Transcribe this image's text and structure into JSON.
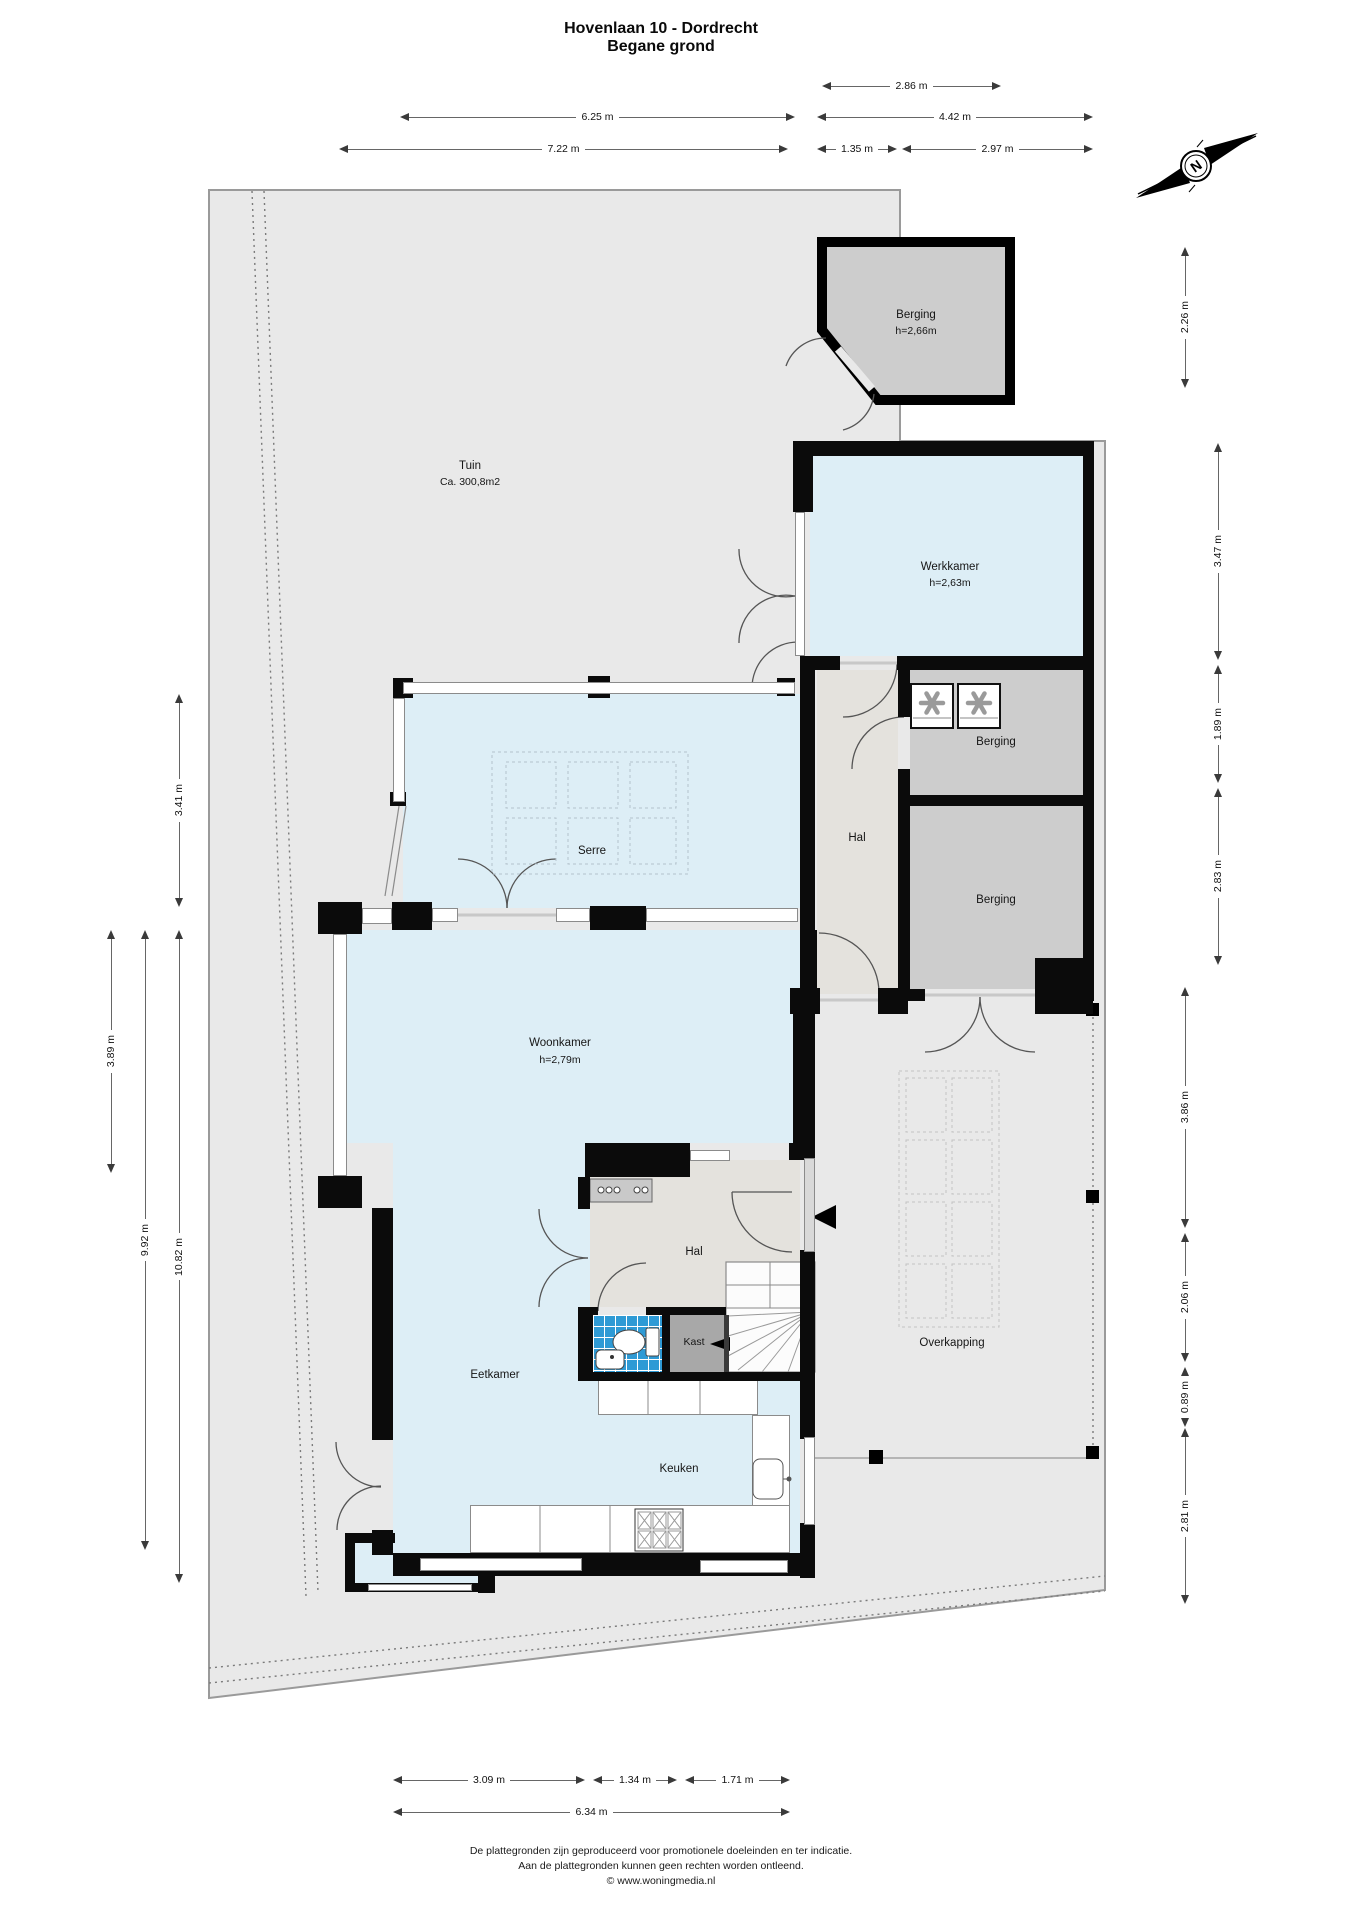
{
  "title": {
    "line1": "Hovenlaan 10 - Dordrecht",
    "line2": "Begane grond"
  },
  "compass": {
    "label": "N"
  },
  "rooms": {
    "tuin": {
      "name": "Tuin",
      "area": "Ca. 300,8m2"
    },
    "berging_tuin": {
      "name": "Berging",
      "ceiling": "h=2,66m"
    },
    "werkkamer": {
      "name": "Werkkamer",
      "ceiling": "h=2,63m"
    },
    "berging_boven": {
      "name": "Berging"
    },
    "berging_onder": {
      "name": "Berging"
    },
    "hal_zij": {
      "name": "Hal"
    },
    "serre": {
      "name": "Serre"
    },
    "woonkamer": {
      "name": "Woonkamer",
      "ceiling": "h=2,79m"
    },
    "hal": {
      "name": "Hal"
    },
    "kast": {
      "name": "Kast"
    },
    "eetkamer": {
      "name": "Eetkamer"
    },
    "keuken": {
      "name": "Keuken"
    },
    "overkapping": {
      "name": "Overkapping"
    }
  },
  "dimensions": {
    "top": [
      "2.86 m",
      "6.25 m",
      "4.42 m",
      "7.22 m",
      "1.35 m",
      "2.97 m"
    ],
    "left": [
      "3.41 m",
      "3.89 m",
      "9.92 m",
      "10.82 m"
    ],
    "right": [
      "2.26 m",
      "3.47 m",
      "1.89 m",
      "2.83 m",
      "3.86 m",
      "2.06 m",
      "0.89 m",
      "2.81 m"
    ],
    "bottom": [
      "3.09 m",
      "1.34 m",
      "1.71 m",
      "6.34 m"
    ]
  },
  "footer": {
    "line1": "De plattegronden zijn geproduceerd voor promotionele doeleinden en ter indicatie.",
    "line2": "Aan de plattegronden kunnen geen rechten worden ontleend.",
    "line3": "© www.woningmedia.nl"
  },
  "colors": {
    "wall": "#0b0b0b",
    "room_fill_blue": "#ddeef6",
    "hal_fill": "#e4e2dd",
    "berging_fill": "#cdcdcd",
    "kast_fill": "#a8a8a8",
    "wc_tile_blue": "#2e9ad5",
    "plot_fill": "#e9e9e9"
  }
}
